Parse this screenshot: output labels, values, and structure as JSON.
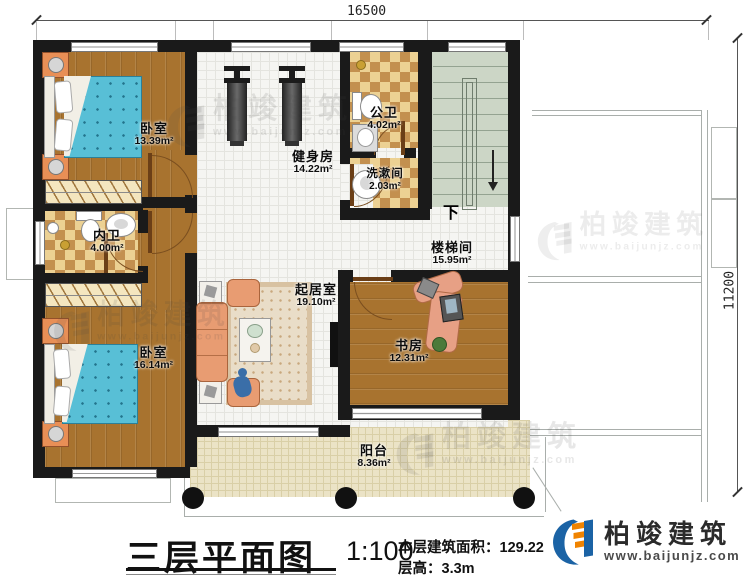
{
  "dimensions": {
    "width_mm": "16500",
    "height_mm": "11200"
  },
  "rooms": [
    {
      "id": "bedroom-top",
      "name": "卧室",
      "area": "13.39m²"
    },
    {
      "id": "gym",
      "name": "健身房",
      "area": "14.22m²"
    },
    {
      "id": "public-bath",
      "name": "公卫",
      "area": "4.02m²"
    },
    {
      "id": "washroom",
      "name": "洗漱间",
      "area": "2.03m²"
    },
    {
      "id": "inner-bath",
      "name": "内卫",
      "area": "4.00m²"
    },
    {
      "id": "stairwell",
      "name": "楼梯间",
      "area": "15.95m²"
    },
    {
      "id": "living-room",
      "name": "起居室",
      "area": "19.10m²"
    },
    {
      "id": "bedroom-bottom",
      "name": "卧室",
      "area": "16.14m²"
    },
    {
      "id": "study",
      "name": "书房",
      "area": "12.31m²"
    },
    {
      "id": "balcony",
      "name": "阳台",
      "area": "8.36m²"
    }
  ],
  "stairs": {
    "direction_label": "下"
  },
  "title_block": {
    "plan_title": "三层平面图",
    "scale": "1:100",
    "area_label": "本层建筑面积：",
    "area_value": "129.22m²",
    "height_label": "层高：",
    "height_value": "3.3m"
  },
  "brand": {
    "company": "柏竣建筑",
    "website": "www.baijunjz.com"
  },
  "colors": {
    "wall": "#1a1a1a",
    "wood_floor": "#a8732f",
    "bath_checker": "#c3904f",
    "stair_fill": "#ccd6c6",
    "balcony_tile": "#ebe3c6",
    "bed": "#58bfd6",
    "sofa": "#e89c72",
    "logo_blue": "#1b63a5",
    "logo_orange": "#f08300"
  }
}
